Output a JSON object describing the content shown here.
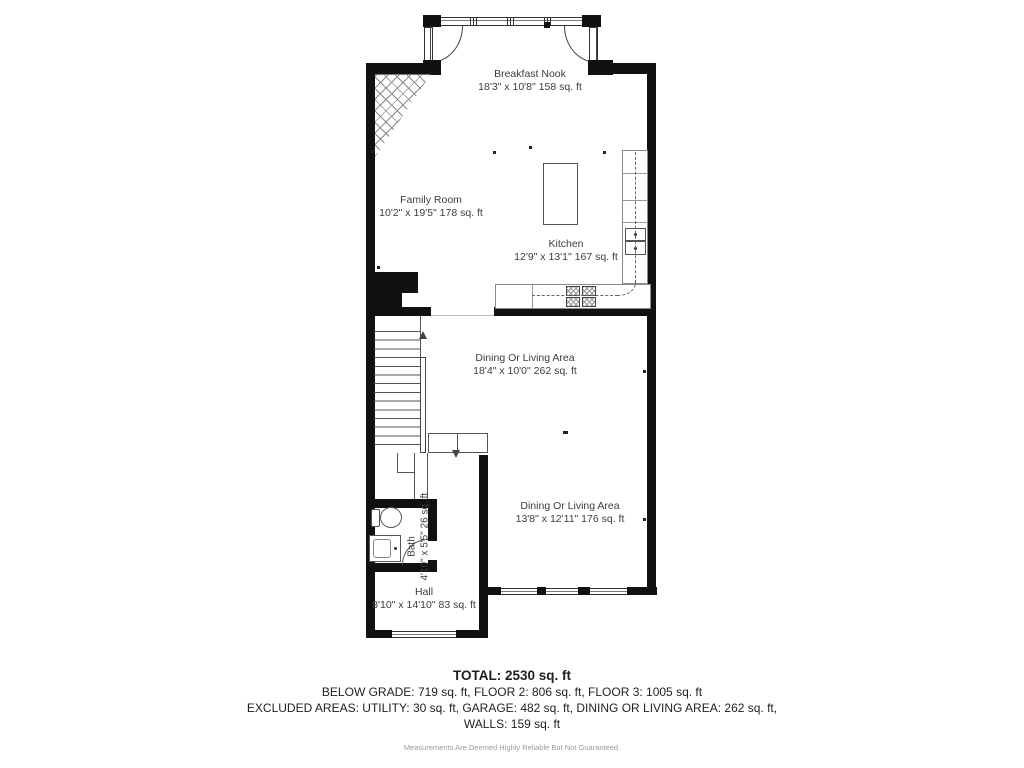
{
  "rooms": {
    "breakfast_nook": {
      "name": "Breakfast Nook",
      "dims": "18'3\" x 10'8\" 158 sq. ft"
    },
    "family_room": {
      "name": "Family Room",
      "dims": "10'2\" x 19'5\" 178 sq. ft"
    },
    "kitchen": {
      "name": "Kitchen",
      "dims": "12'9\" x 13'1\" 167 sq. ft"
    },
    "dining_mid": {
      "name": "Dining Or Living Area",
      "dims": "18'4\" x 10'0\" 262 sq. ft"
    },
    "dining_lower": {
      "name": "Dining Or Living Area",
      "dims": "13'8\" x 12'11\" 176 sq. ft"
    },
    "bath": {
      "name": "Bath",
      "dims": "4'10\" x 5'5\" 26 sq. ft"
    },
    "hall": {
      "name": "Hall",
      "dims": "8'10\" x 14'10\" 83 sq. ft"
    }
  },
  "summary": {
    "total": "TOTAL: 2530 sq. ft",
    "line1": "BELOW GRADE: 719 sq. ft, FLOOR 2: 806 sq. ft, FLOOR 3: 1005 sq. ft",
    "line2": "EXCLUDED AREAS: UTILITY: 30 sq. ft, GARAGE: 482 sq. ft, DINING OR LIVING AREA: 262 sq. ft,",
    "line3": "WALLS: 159 sq. ft",
    "disclaimer": "Measurements Are Deemed Highly Reliable But Not Guaranteed."
  },
  "colors": {
    "wall": "#111111",
    "line": "#555555",
    "label_text": "#3d3d3d",
    "disclaimer_text": "#9a9a9a"
  }
}
